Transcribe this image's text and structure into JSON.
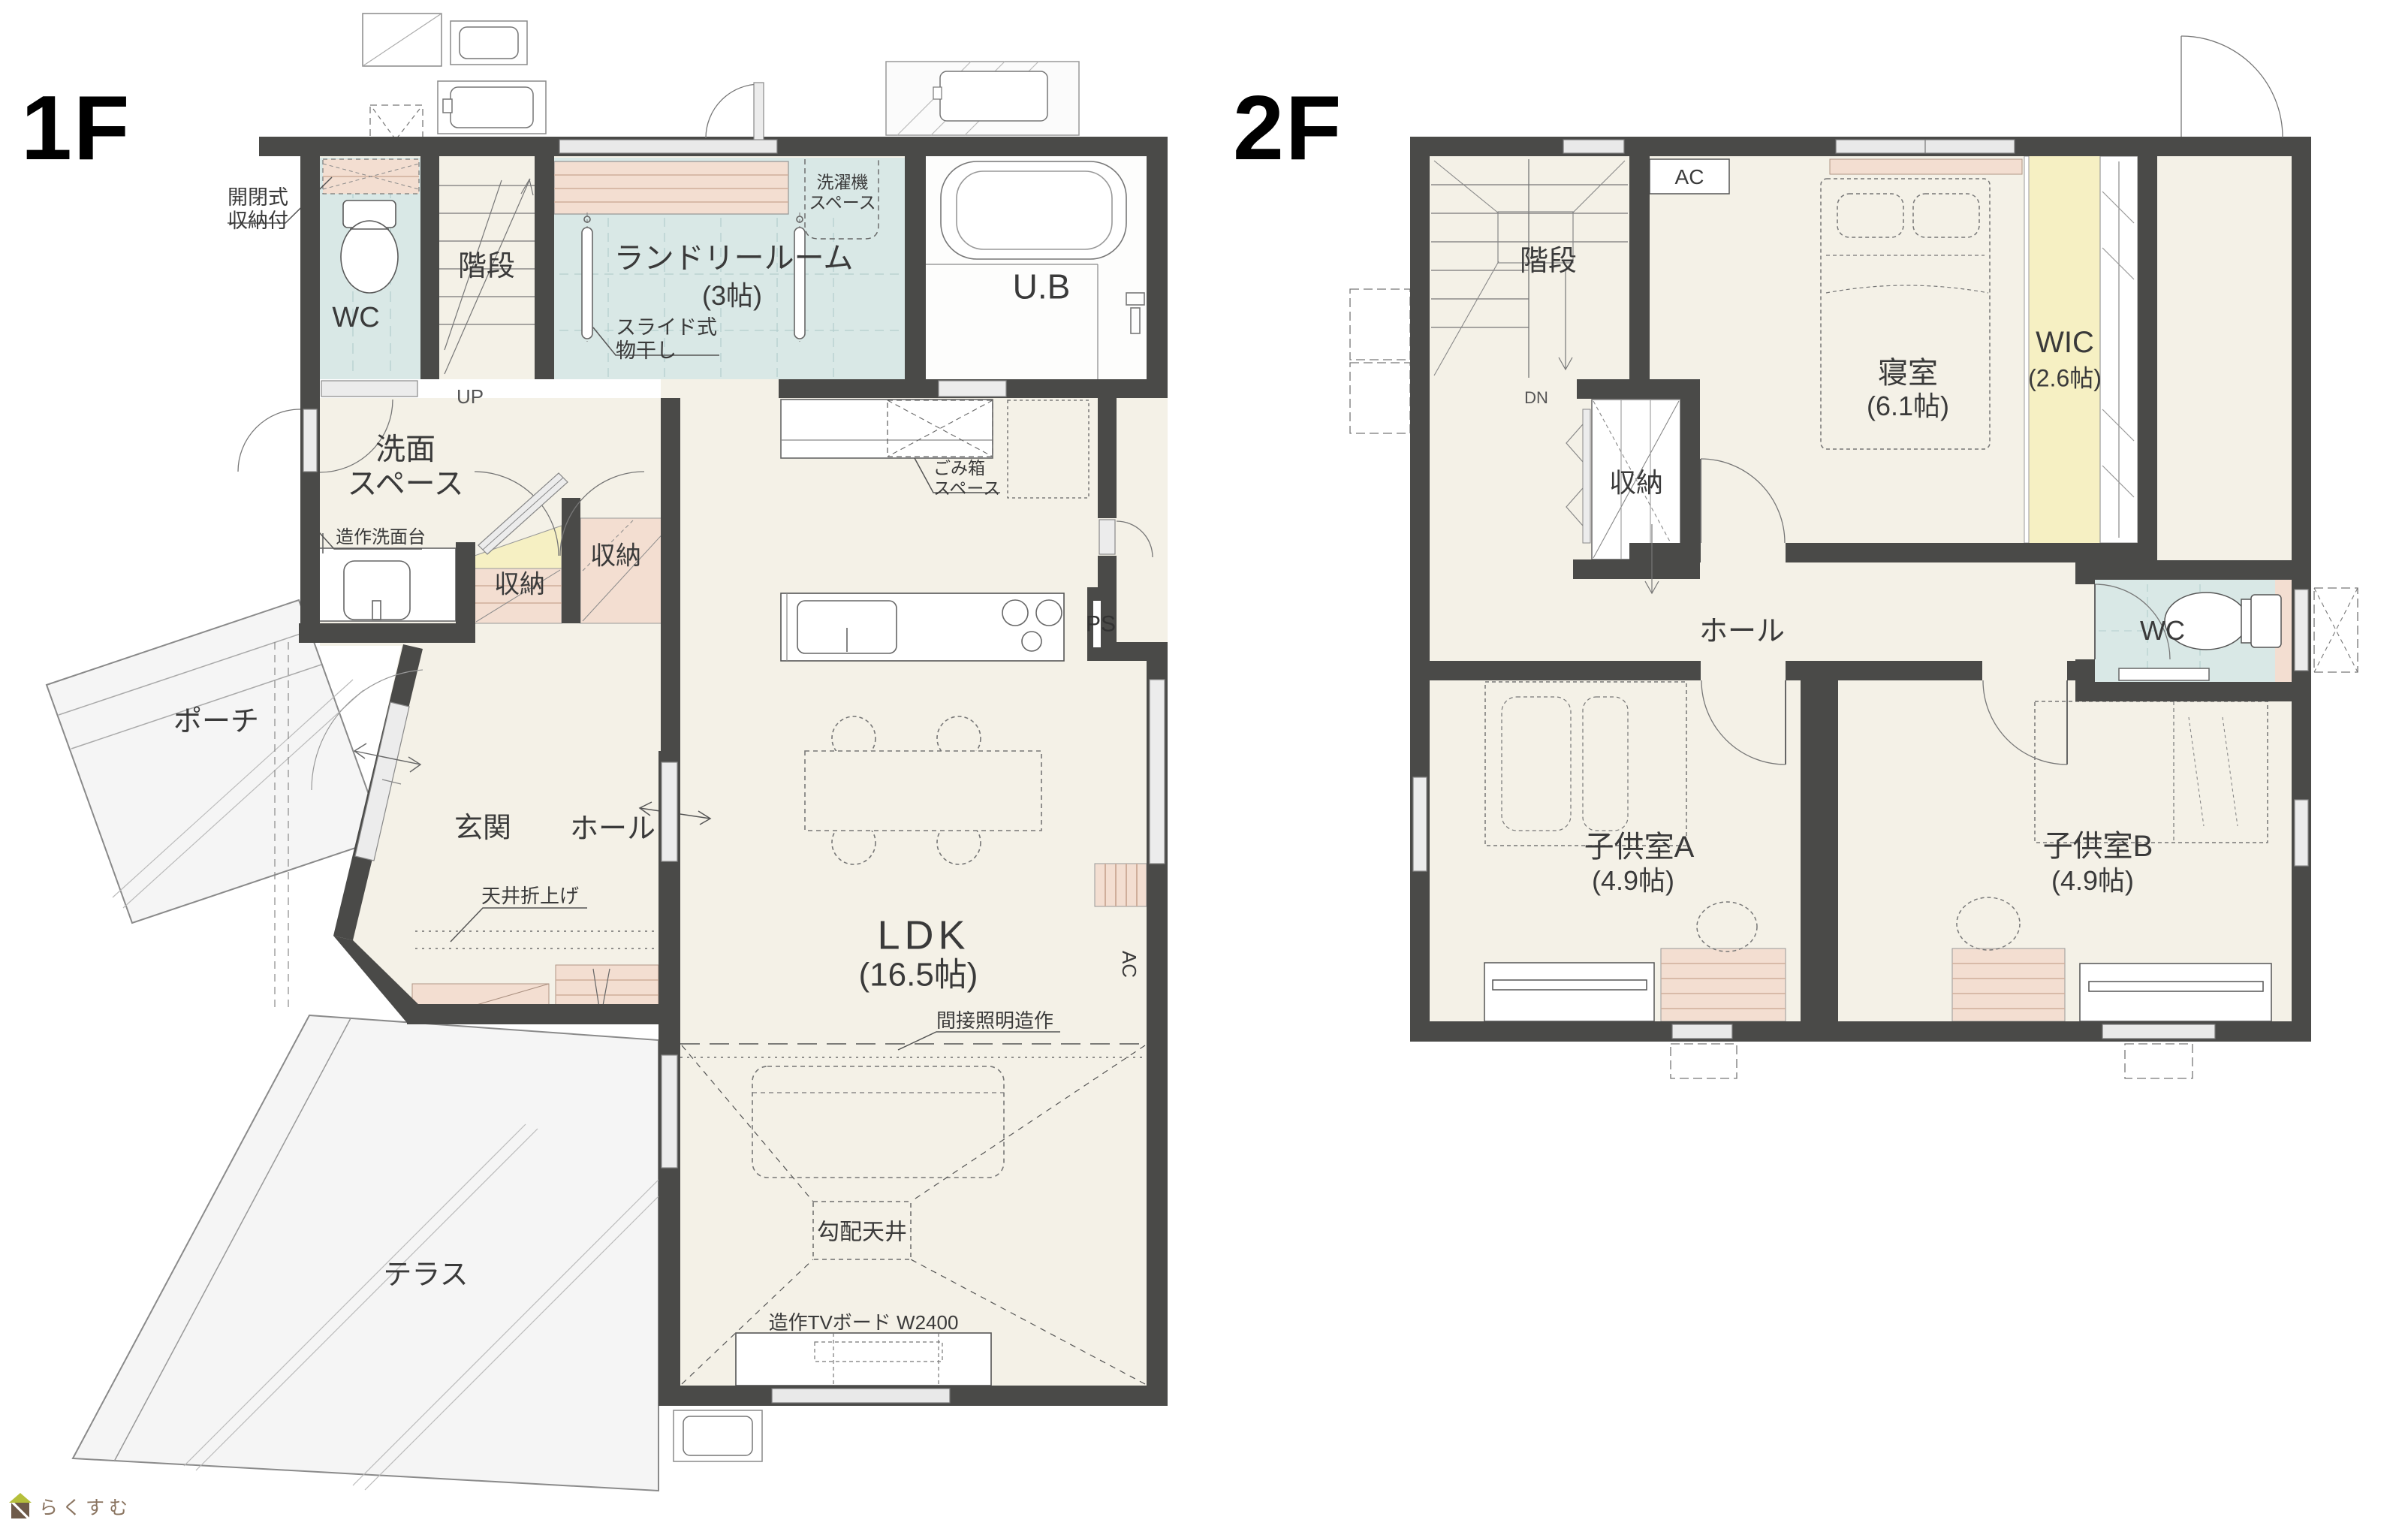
{
  "page": {
    "logo_text": "らくすむ"
  },
  "floor1": {
    "label": "1F",
    "rooms": {
      "wc": "WC",
      "stairs": "階段",
      "laundry": "ランドリールーム",
      "laundry_size": "(3帖)",
      "ub": "U.B",
      "washroom": "洗面\nスペース",
      "storage_a": "収納",
      "storage_b": "収納",
      "porch": "ポーチ",
      "entrance": "玄関",
      "hall": "ホール",
      "ldk": "LDK",
      "ldk_size": "(16.5帖)",
      "terrace": "テラス"
    },
    "notes": {
      "hinged_storage": "開閉式\n収納付",
      "washer_space": "洗濯機\nスペース",
      "slide_rack": "スライド式\n物干し",
      "up": "UP",
      "vanity": "造作洗面台",
      "trash_space": "ごみ箱\nスペース",
      "ps": "PS",
      "ceiling_fold": "天井折上げ",
      "indirect_light": "間接照明造作",
      "sloped_ceiling": "勾配天井",
      "tv_board": "造作TVボード W2400",
      "ac": "AC"
    }
  },
  "floor2": {
    "label": "2F",
    "rooms": {
      "stairs": "階段",
      "bedroom": "寝室",
      "bedroom_size": "(6.1帖)",
      "wic": "WIC",
      "wic_size": "(2.6帖)",
      "storage": "収納",
      "hall": "ホール",
      "wc": "WC",
      "kid_a": "子供室A",
      "kid_a_size": "(4.9帖)",
      "kid_b": "子供室B",
      "kid_b_size": "(4.9帖)"
    },
    "notes": {
      "ac": "AC",
      "dn": "DN"
    }
  }
}
